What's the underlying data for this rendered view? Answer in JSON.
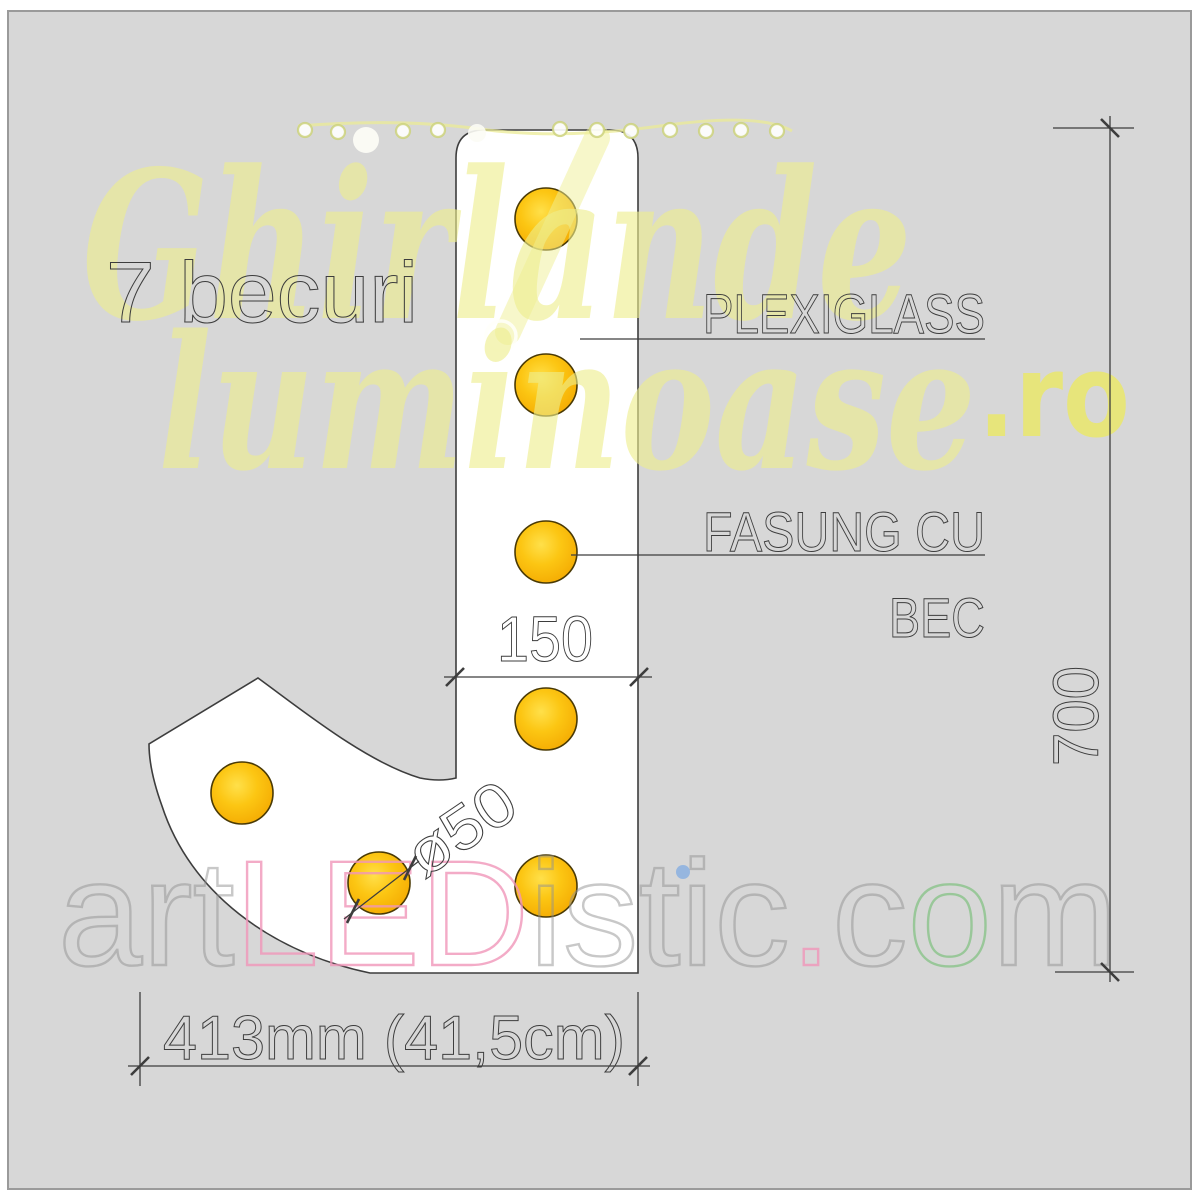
{
  "drawing_title": {
    "text": "7 becuri"
  },
  "callouts": {
    "plexiglass": "PLEXIGLASS",
    "socket_line1": "FASUNG CU",
    "socket_line2": "BEC"
  },
  "dimensions": {
    "stem_width_mm": "150",
    "total_height_mm": "700",
    "total_width": "413mm (41,5cm)",
    "bulb_diameter": "ø50"
  },
  "figure": {
    "shape": "letter-J-sign-panel",
    "bulb_count": 7
  },
  "watermarks": {
    "brand_script_line1": "Ghirlande",
    "brand_script_line2": "luminoase",
    "brand_tld": ".ro",
    "footer": {
      "art": "art",
      "led": "LED",
      "istic": "istic",
      "dot": ".",
      "c": "c",
      "o": "o",
      "m": "m"
    }
  },
  "colors": {
    "canvas_bg": "#d7d7d7",
    "frame_stroke": "#9a9a9a",
    "panel_fill": "#ffffff",
    "line": "#3d3d3d",
    "bulb_fill": "#fcc613",
    "bulb_highlight": "#ffe04a",
    "bulb_shade": "#f2a806",
    "bulb_stroke": "#4a3a05",
    "watermark_yellow": "#eeee8c",
    "watermark_pink": "#f096b9",
    "watermark_green": "#78be78",
    "watermark_gray": "#919191",
    "watermark_blue_dot": "#8fb3e0"
  }
}
